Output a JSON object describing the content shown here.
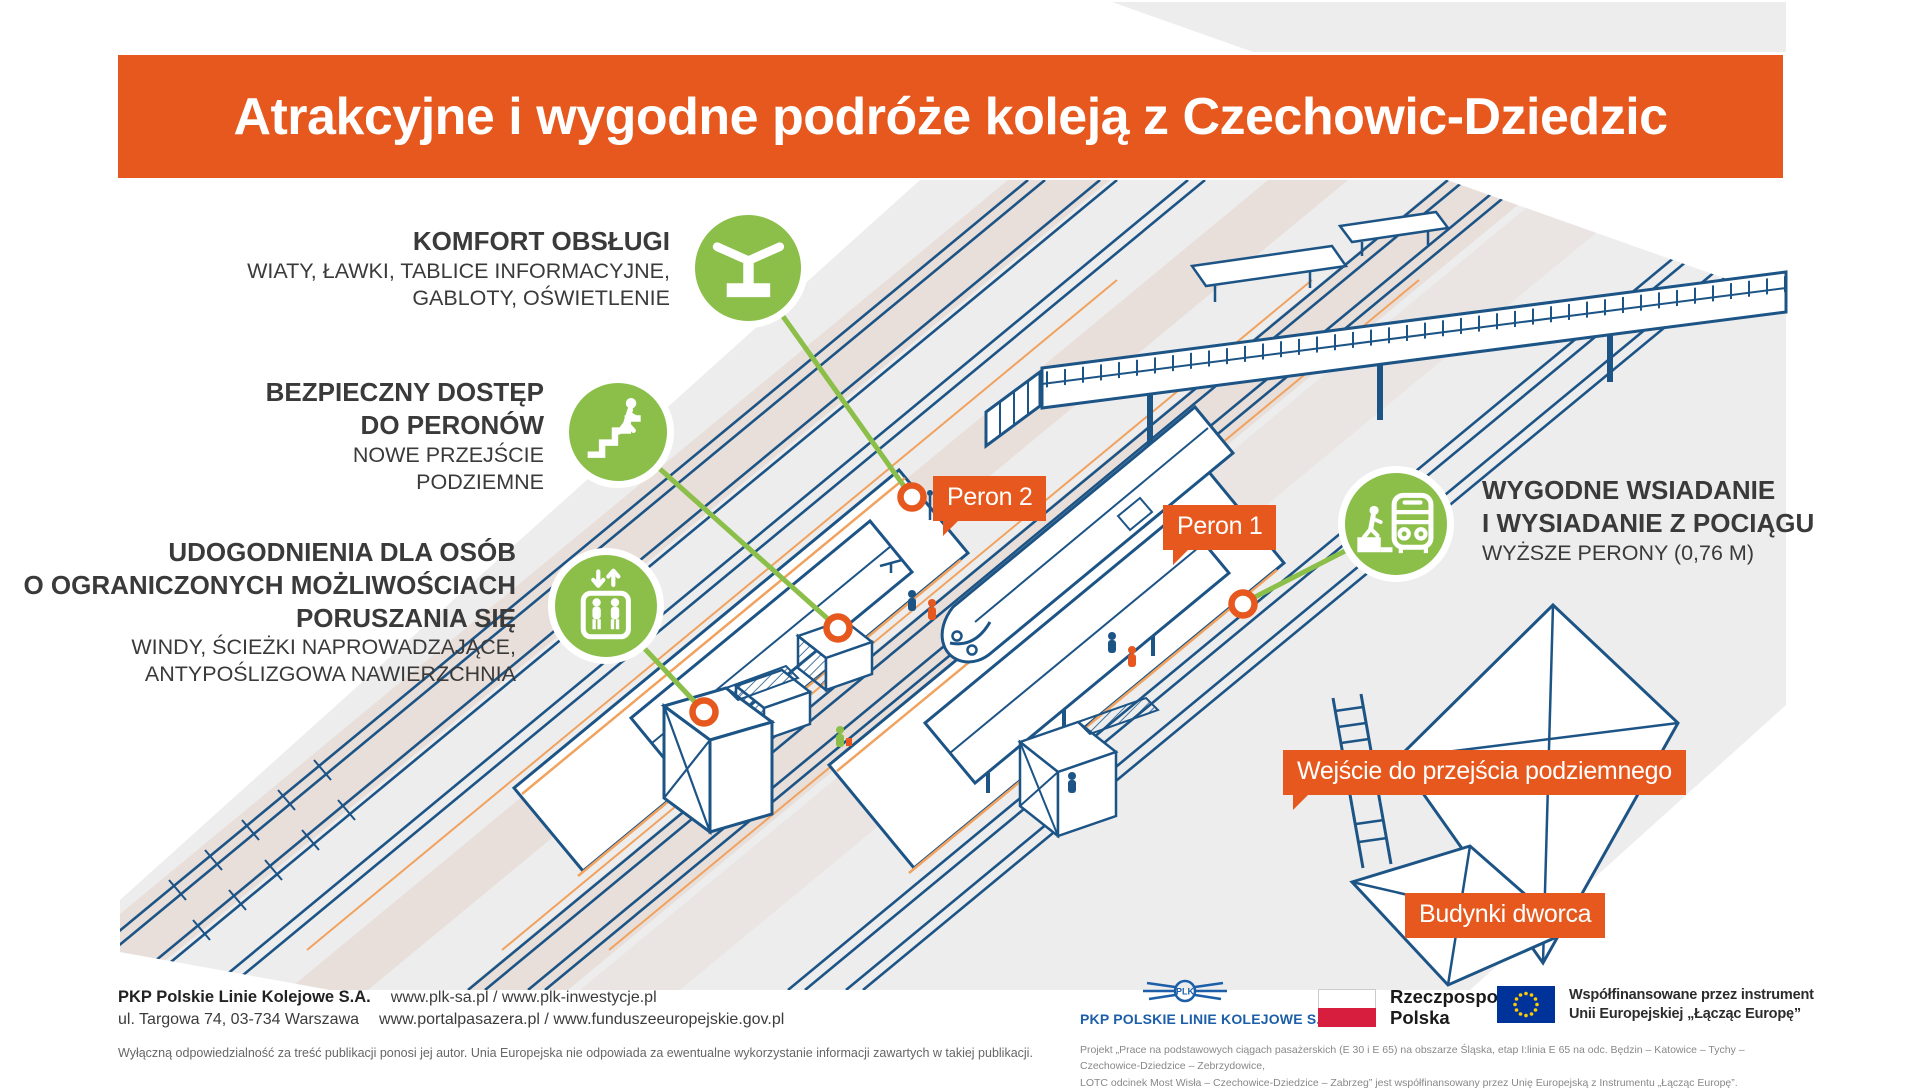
{
  "header": {
    "title": "Atrakcyjne i wygodne podróże koleją z Czechowic-Dziedzic"
  },
  "callouts": {
    "komfort": {
      "icon": "canopy-icon",
      "title1": "KOMFORT OBSŁUGI",
      "sub1": "WIATY, ŁAWKI, TABLICE INFORMACYJNE,",
      "sub2": "GABLOTY, OŚWIETLENIE"
    },
    "dostep": {
      "icon": "stairs-icon",
      "title1": "BEZPIECZNY DOSTĘP",
      "title2": "DO PERONÓW",
      "sub1": "NOWE PRZEJŚCIE",
      "sub2": "PODZIEMNE"
    },
    "udogodnienia": {
      "icon": "elevator-icon",
      "title1": "UDOGODNIENIA DLA OSÓB",
      "title2": "O OGRANICZONYCH MOŻLIWOŚCIACH",
      "title3": "PORUSZANIA SIĘ",
      "sub1": "WINDY, ŚCIEŻKI NAPROWADZAJĄCE,",
      "sub2": "ANTYPOŚLIZGOWA NAWIERZCHNIA"
    },
    "wsiadanie": {
      "icon": "train-boarding-icon",
      "title1": "WYGODNE WSIADANIE",
      "title2": "I WYSIADANIE Z POCIĄGU",
      "sub1": "WYŻSZE PERONY (0,76 M)"
    }
  },
  "map_labels": {
    "peron2": "Peron 2",
    "peron1": "Peron 1",
    "underpass": "Wejście do przejścia podziemnego",
    "station": "Budynki dworca"
  },
  "footer": {
    "company_bold": "PKP Polskie Linie Kolejowe S.A.",
    "links1": "www.plk-sa.pl  /  www.plk-inwestycje.pl",
    "address": "ul. Targowa 74, 03-734 Warszawa",
    "links2": "www.portalpasazera.pl  /  www.funduszeeuropejskie.gov.pl",
    "disclaimer": "Wyłączną odpowiedzialność za treść publikacji ponosi jej autor. Unia Europejska nie odpowiada za ewentualne wykorzystanie informacji zawartych w takiej publikacji.",
    "pkp_emblem_text": "PLK",
    "pkp_logo_text": "PKP POLSKIE LINIE KOLEJOWE S.A.",
    "poland_line1": "Rzeczpospolita",
    "poland_line2": "Polska",
    "eu_line1": "Współfinansowane przez instrument",
    "eu_line2": "Unii Europejskiej „Łącząc Europę”",
    "project_line1": "Projekt „Prace na podstawowych ciągach pasażerskich (E 30 i E 65) na obszarze Śląska, etap I:linia E 65 na odc. Będzin – Katowice – Tychy – Czechowice-Dziedzice – Zebrzydowice,",
    "project_line2": "LOTC odcinek Most Wisła – Czechowice-Dziedzice – Zabrzeg” jest współfinansowany przez Unię Europejską z Instrumentu „Łącząc Europę”."
  },
  "colors": {
    "accent_orange": "#e6581d",
    "accent_green": "#8bbf4a",
    "drawing_navy": "#1d5486",
    "pkp_blue": "#1c5fa8",
    "eu_blue": "#003399",
    "flag_red": "#d81e3f"
  }
}
